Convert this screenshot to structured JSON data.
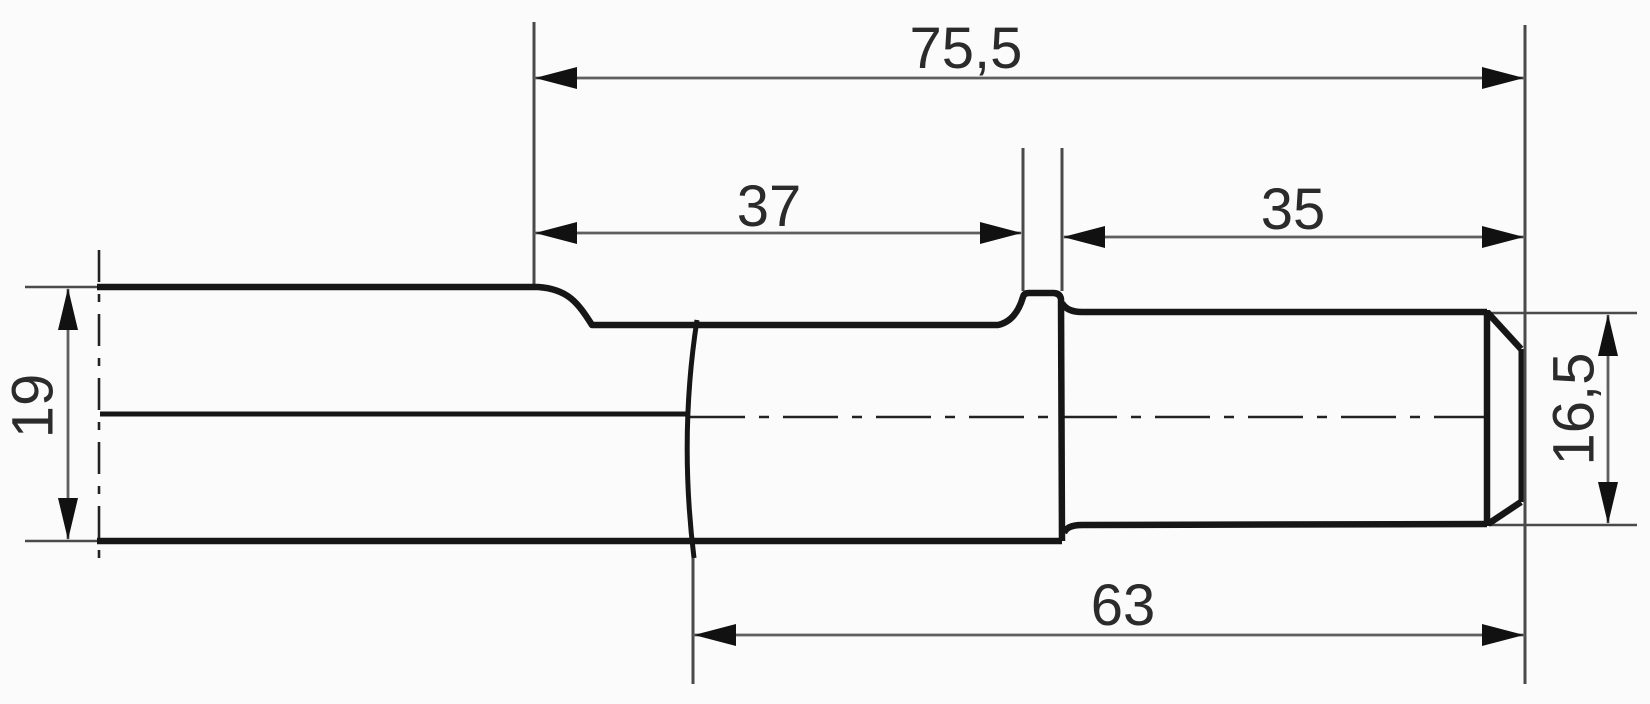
{
  "drawing": {
    "kind": "technical-dimension-drawing",
    "subject": "hex-shank tool bit side view",
    "decimal_style": "comma",
    "colors": {
      "background": "#fbfbfb",
      "part_outline": "#161616",
      "dimension_lines": "#5f5f5f",
      "extension_lines": "#4a4a4a",
      "centerline": "#222222",
      "text": "#2b2b2b"
    },
    "labels": {
      "overall_length": "75,5",
      "collar_length": "37",
      "tip_length": "35",
      "round_length": "63",
      "hex_across_flats": "19",
      "tip_diameter": "16,5"
    }
  }
}
